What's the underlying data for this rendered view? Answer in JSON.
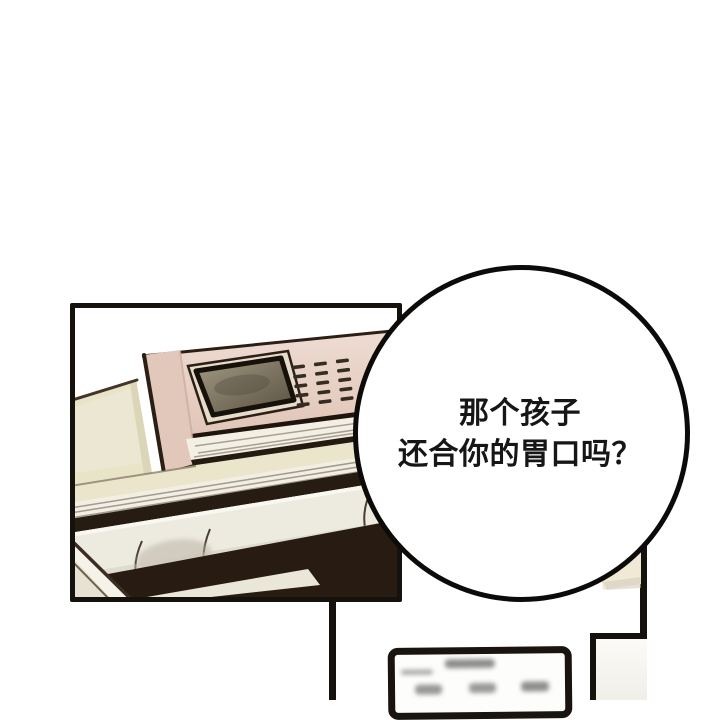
{
  "canvas": {
    "width": 720,
    "height": 700,
    "background": "#ffffff"
  },
  "speech_bubble": {
    "shape": "circle",
    "text_lines": [
      "那个孩子",
      "还合你的胃口吗？"
    ],
    "fill": "#ffffff",
    "stroke_color": "#0d0b09",
    "text_color": "#161616"
  },
  "panels": {
    "still_life": {
      "subject": "device-on-stacked-books-drawing",
      "colors": {
        "ink": "#15110d",
        "cream_book": "#e9e4c8",
        "device_pink": "#e3c9bc",
        "screen_dark": "#57503f",
        "screen_light": "#a39a84",
        "paper_white": "#f3efe4",
        "shadow_brown": "#281c12",
        "roll_light": "#edebe0"
      }
    },
    "bottom_partial": {
      "flyer_border": "#19140f",
      "flyer_fill": "#fdfdfb",
      "border_ink": "#15110d"
    }
  }
}
